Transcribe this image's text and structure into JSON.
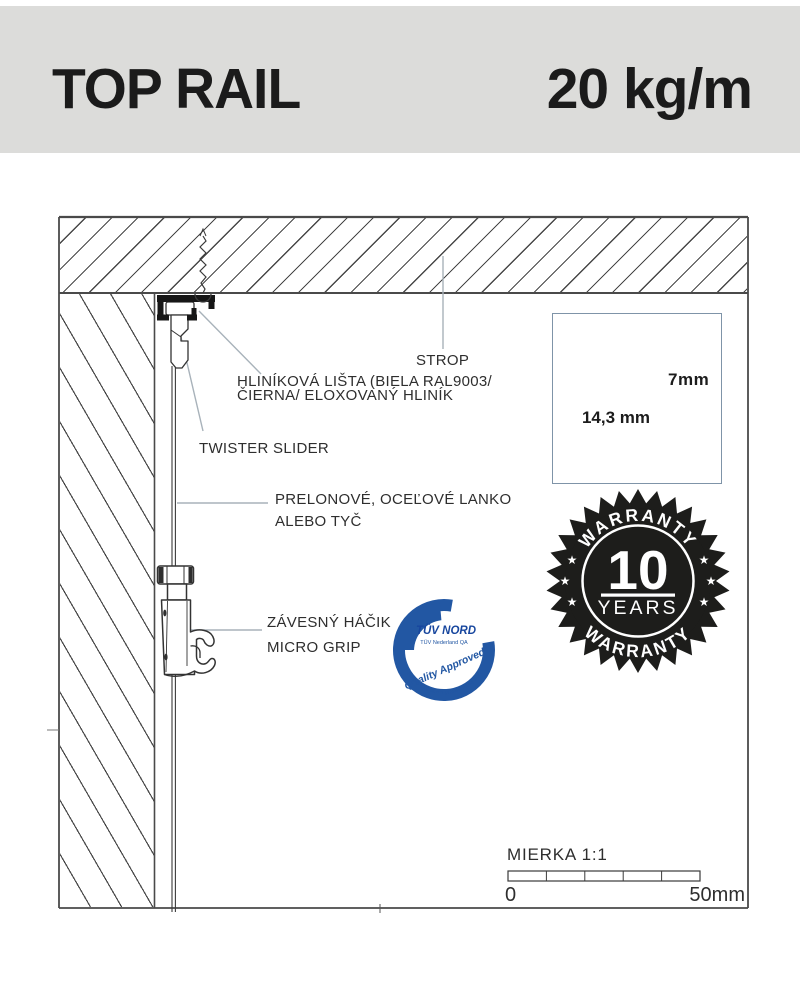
{
  "header": {
    "title": "TOP RAIL",
    "capacity": "20 kg/m"
  },
  "labels": {
    "strop": "STROP",
    "rail_line1": "HLINÍKOVÁ LIŠTA (BIELA RAL9003/",
    "rail_line2": "ČIERNA/ ELOXOVANÝ HLINÍK",
    "twister": "TWISTER SLIDER",
    "wire_line1": "PRELONOVÉ, OCEĽOVÉ LANKO",
    "wire_line2": "ALEBO TYČ",
    "hook_line1": "ZÁVESNÝ HÁČIK",
    "hook_line2": "MICRO GRIP"
  },
  "detail": {
    "width_dim": "14,3 mm",
    "height_dim": "7mm"
  },
  "warranty": {
    "arc_top": "WARRANTY",
    "arc_bottom": "WARRANTY",
    "number": "10",
    "years": "YEARS",
    "star": "★"
  },
  "tuv": {
    "brand": "TÜV NORD",
    "org": "TÜV Nederland QA",
    "quality": "Quality Approved",
    "cert": "2400-4-618  Micro grip® Artiteq B.V."
  },
  "scale": {
    "label": "MIERKA 1:1",
    "start": "0",
    "end": "50mm"
  },
  "colors": {
    "header_bg": "#dcdcda",
    "badge_black": "#1d1d1b",
    "tuv_blue": "#2257a3",
    "leader_gray": "#a8b2ba",
    "detail_border": "#7f94a8"
  }
}
